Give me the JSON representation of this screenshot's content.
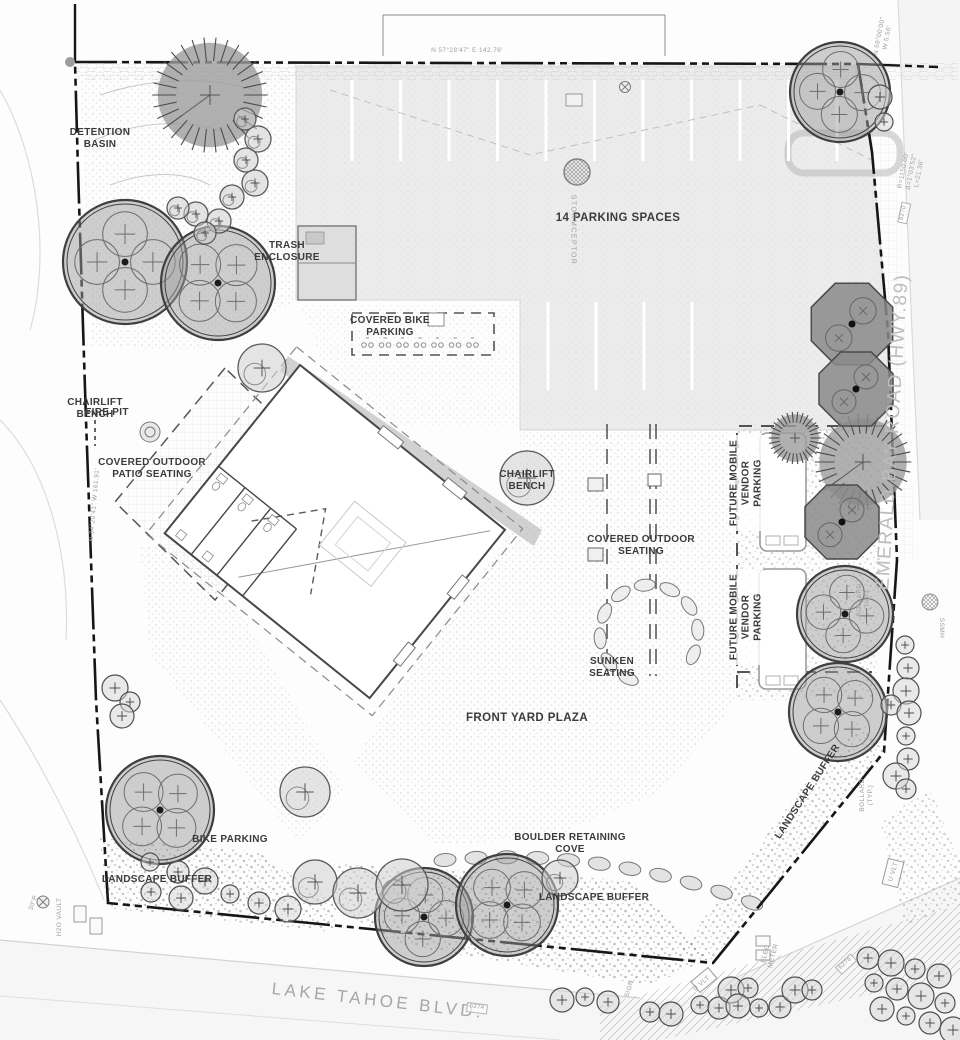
{
  "labels": {
    "detention_basin": "DETENTION BASIN",
    "trash_enclosure": "TRASH ENCLOSURE",
    "fire_pit": "FIRE PIT",
    "chairlift_bench": "CHAIRLIFT BENCH",
    "covered_patio_seating": "COVERED OUTDOOR PATIO SEATING",
    "parking_spaces": "14 PARKING SPACES",
    "covered_bike_parking": "COVERED BIKE PARKING",
    "covered_outdoor_seating": "COVERED OUTDOOR SEATING",
    "future_mobile_vendor_parking": "FUTURE MOBILE VENDOR PARKING",
    "sunken_seating": "SUNKEN SEATING",
    "front_yard_plaza": "FRONT YARD PLAZA",
    "bike_parking": "BIKE PARKING",
    "landscape_buffer": "LANDSCAPE BUFFER",
    "boulder_retaining_cove": "BOULDER RETAINING COVE",
    "lake_tahoe_blvd": "LAKE TAHOE BLVD.",
    "emerald_bay_road": "EMERALD BAY ROAD (HWY.89)"
  },
  "annotations": {
    "bearing_north": "N 57°28'47\" E   142.76'",
    "bearing_west": "N 34°20'41\" W  161.91'",
    "bearing_ne": "N 59°00'00\" W  5.56'",
    "curve_data": "R=1150.00' Δ=1°03'52\" L=21.36'",
    "stormceptor": "STORMCEPTOR",
    "ssmh": "SSMH",
    "bollard": "BOLLARD (TYP.)",
    "u_vlt": "U VLT",
    "h2o_vault": "H2O VAULT",
    "pipe30": "30\"P",
    "elec_meter": "ELEC METER",
    "sign": "SIGN",
    "elev_6270": "6270",
    "elev_6274": "6274",
    "elev_6276": "6276"
  },
  "colors": {
    "label": "#3b3b3b",
    "boundary_line": "#161616",
    "tree_fill": "#9e9e9e",
    "tree_outline": "#3f3f3f",
    "asphalt": "#ececec",
    "road_label": "#a6a6a6"
  }
}
